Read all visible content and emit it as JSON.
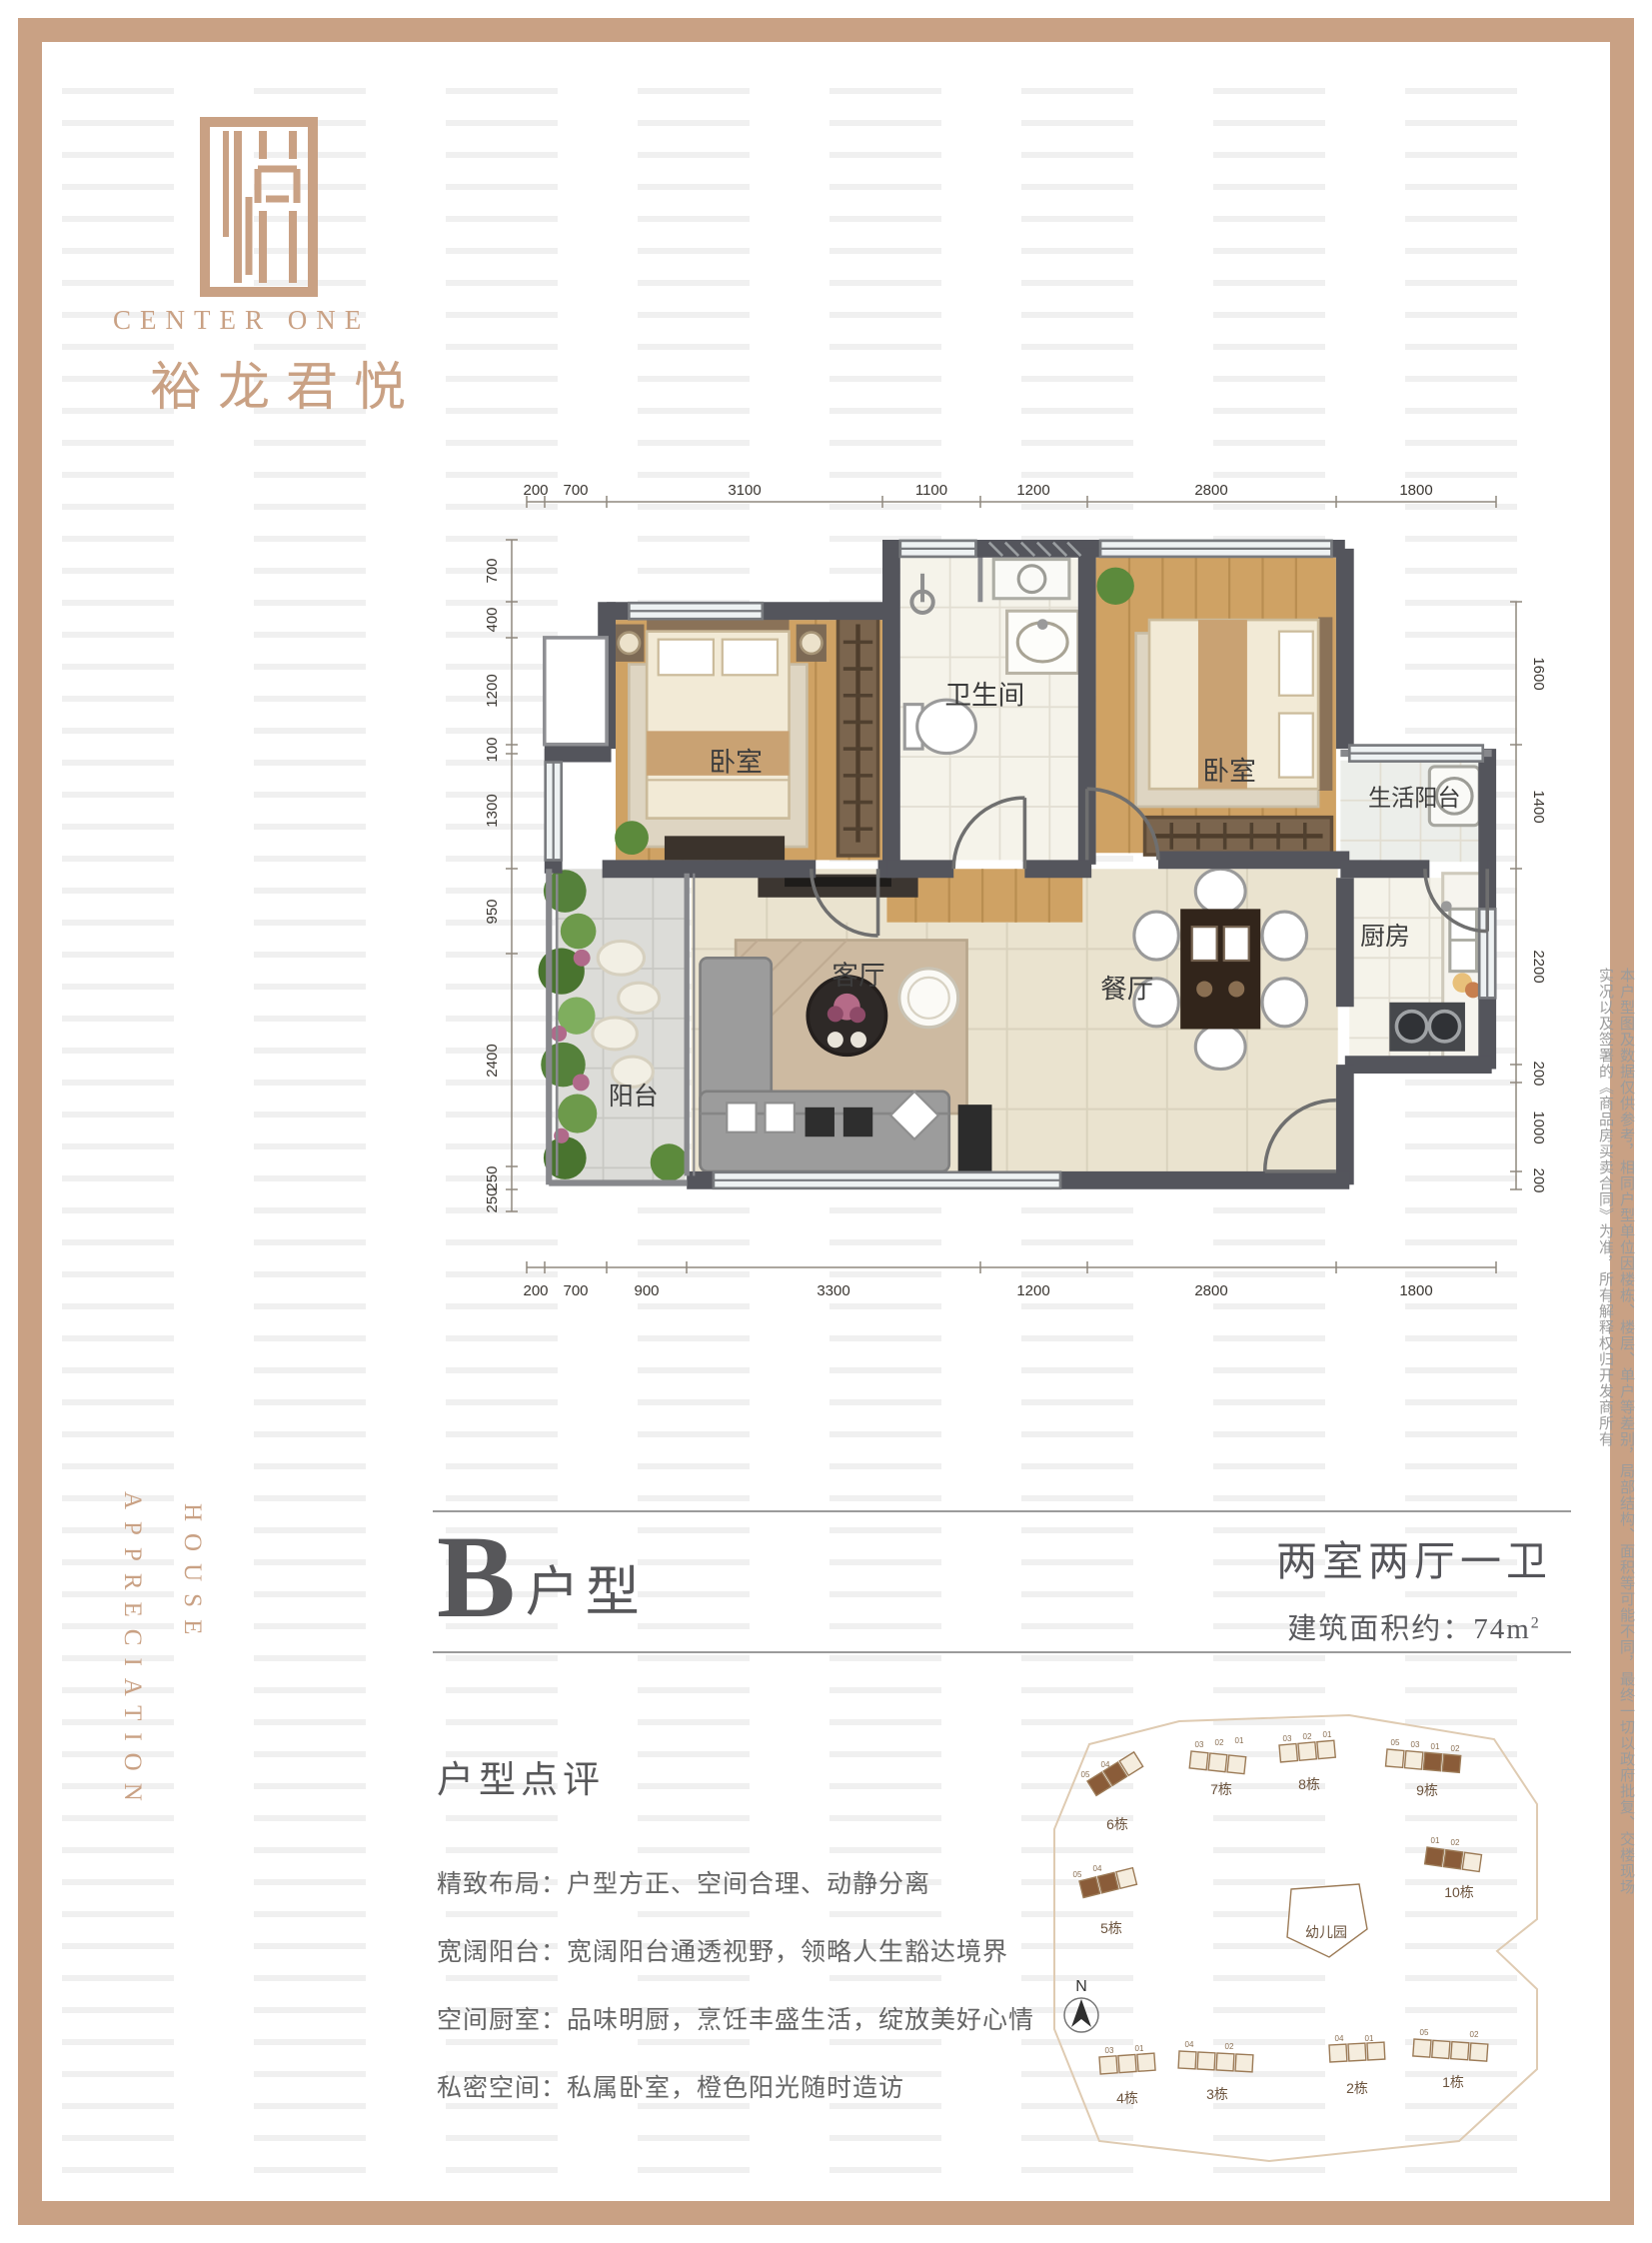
{
  "brand": {
    "logo": "center-one-monogram",
    "name_en": "CENTER ONE",
    "name_cn": "裕龙君悦"
  },
  "vertical_labels": {
    "house": "HOUSE",
    "appreciation": "APPRECIATION"
  },
  "disclaimer": "本户型图及数据仅供参考，相同户型单位因楼栋、楼层、单户等差别，局部结构、面积等可能不同，最终一切以政府批复、交楼现场实况以及签署的《商品房买卖合同》为准，所有解释权归开发商所有",
  "plan": {
    "rooms": {
      "bedroom1": "卧室",
      "bathroom": "卫生间",
      "bedroom2": "卧室",
      "service_balcony": "生活阳台",
      "living": "客厅",
      "dining": "餐厅",
      "kitchen": "厨房",
      "balcony": "阳台"
    },
    "dims": {
      "top": [
        "200",
        "700",
        "3100",
        "1100",
        "1200",
        "2800",
        "1800"
      ],
      "bottom": [
        "200",
        "700",
        "900",
        "3300",
        "1200",
        "2800",
        "1800"
      ],
      "left": [
        "700",
        "400",
        "1200",
        "100",
        "1300",
        "950",
        "2400",
        "250",
        "250"
      ],
      "right": [
        "1600",
        "1400",
        "2200",
        "200",
        "1000",
        "200"
      ]
    }
  },
  "title": {
    "type_letter": "B",
    "type_word": "户型",
    "layout": "两室两厅一卫",
    "area_label": "建筑面积约：",
    "area_value": "74m",
    "area_exp": "2"
  },
  "review": {
    "heading": "户型点评",
    "items": [
      "精致布局：户型方正、空间合理、动静分离",
      "宽阔阳台：宽阔阳台通透视野，领略人生豁达境界",
      "空间厨室：品味明厨，烹饪丰盛生活，绽放美好心情",
      "私密空间：私属卧室，橙色阳光随时造访"
    ]
  },
  "siteplan": {
    "north": "N",
    "kindergarten": "幼儿园",
    "buildings": {
      "b1": "1栋",
      "b2": "2栋",
      "b3": "3栋",
      "b4": "4栋",
      "b5": "5栋",
      "b6": "6栋",
      "b7": "7栋",
      "b8": "8栋",
      "b9": "9栋",
      "b10": "10栋"
    },
    "units": {
      "u01": "01",
      "u02": "02",
      "u03": "03",
      "u04": "04",
      "u05": "05"
    }
  },
  "colors": {
    "accent_tan": "#c9a184",
    "wall_gray": "#54555c",
    "title_gray": "#57575a"
  }
}
